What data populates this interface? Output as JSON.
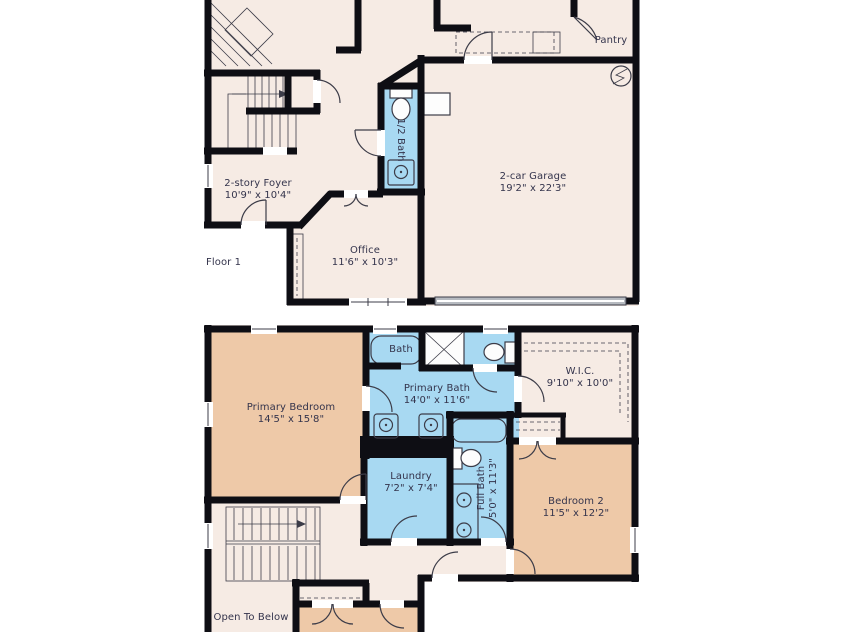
{
  "colors": {
    "floor": "#f6ebe4",
    "bedroom": "#eec9a8",
    "bath": "#a8d9f2",
    "wall": "#0e0e14",
    "fixture": "#3c3c48",
    "text": "#34344c",
    "garage_door": "#b6bac0"
  },
  "floor1": {
    "label": "Floor 1",
    "rooms": {
      "foyer": {
        "name": "2-story Foyer",
        "dims": "10'9\" x 10'4\""
      },
      "half_bath": {
        "name": "1/2 Bath"
      },
      "office": {
        "name": "Office",
        "dims": "11'6\" x 10'3\""
      },
      "garage": {
        "name": "2-car Garage",
        "dims": "19'2\" x 22'3\""
      },
      "pantry": {
        "name": "Pantry"
      }
    }
  },
  "floor2": {
    "rooms": {
      "primary_bedroom": {
        "name": "Primary Bedroom",
        "dims": "14'5\" x 15'8\""
      },
      "bath": {
        "name": "Bath"
      },
      "primary_bath": {
        "name": "Primary Bath",
        "dims": "14'0\" x 11'6\""
      },
      "wic": {
        "name": "W.I.C.",
        "dims": "9'10\" x 10'0\""
      },
      "laundry": {
        "name": "Laundry",
        "dims": "7'2\" x 7'4\""
      },
      "full_bath": {
        "name": "Full Bath",
        "dims": "5'0\" x 11'3\""
      },
      "bedroom2": {
        "name": "Bedroom 2",
        "dims": "11'5\" x 12'2\""
      },
      "open_to_below": {
        "name": "Open To Below"
      }
    }
  }
}
